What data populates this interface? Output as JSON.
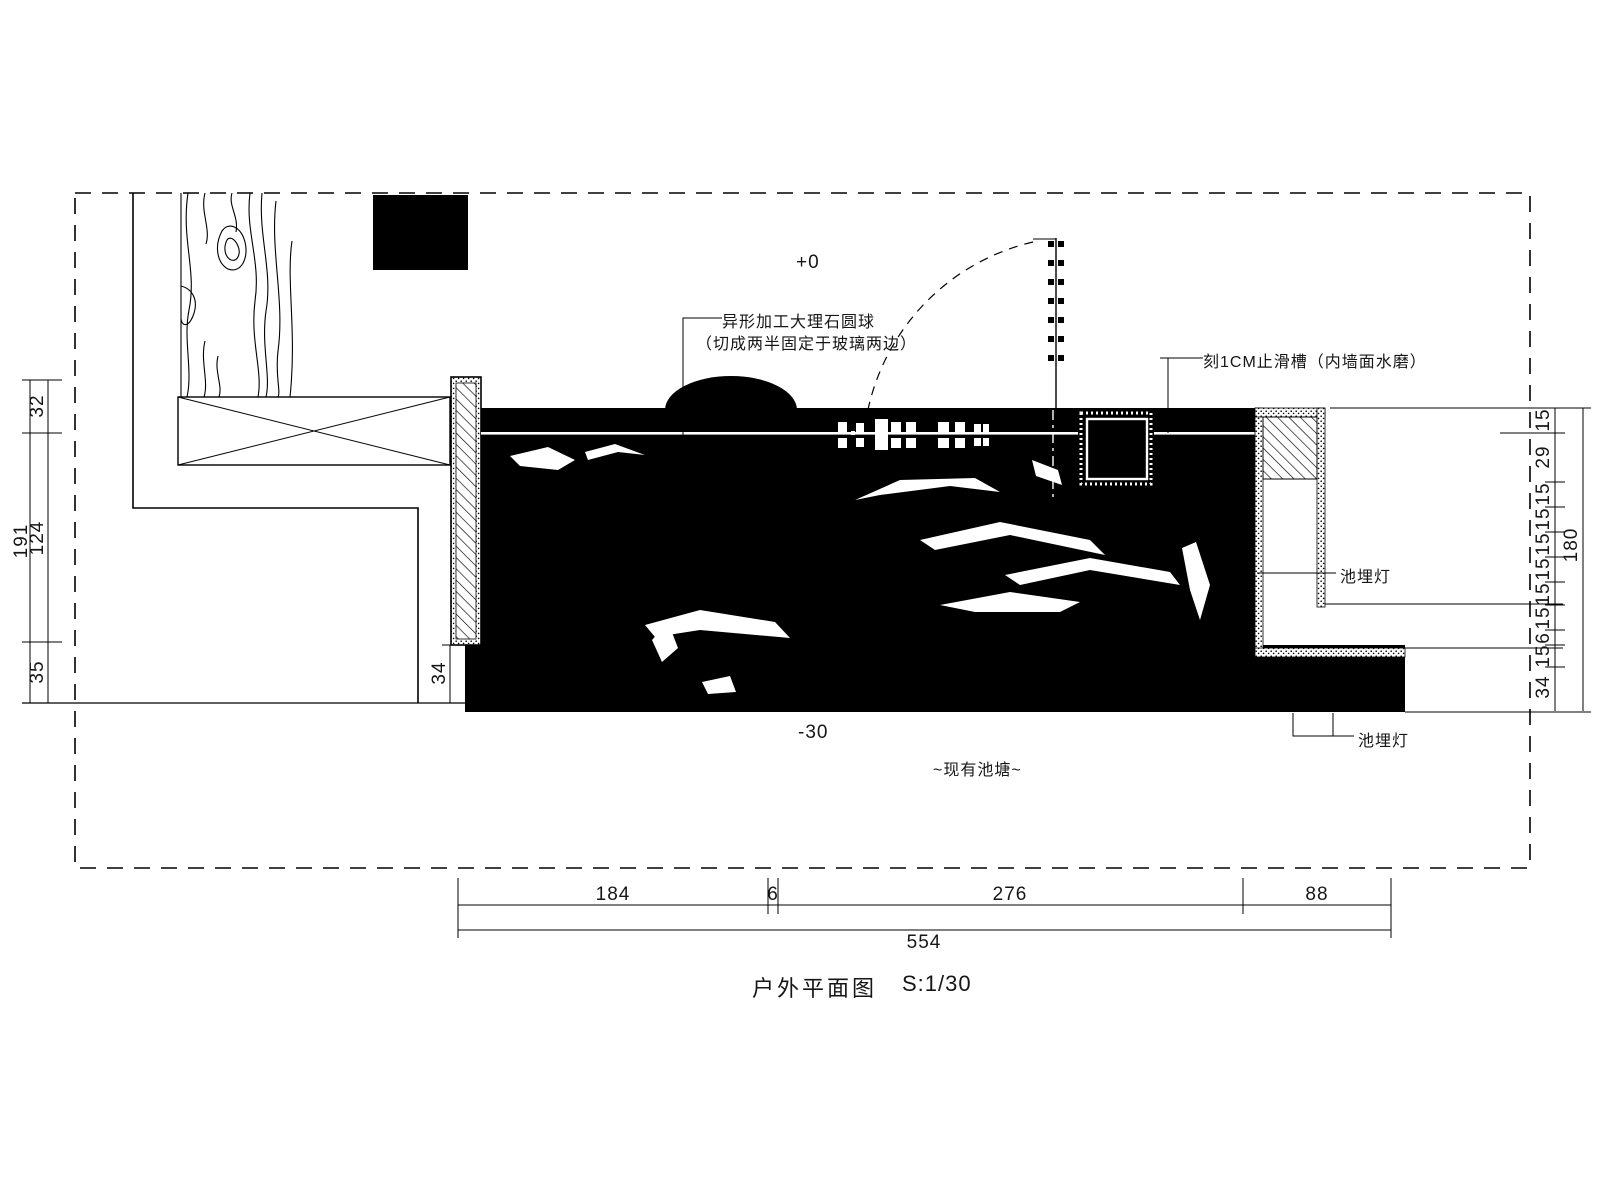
{
  "drawing": {
    "title": "户外平面图",
    "scale": "S:1/30",
    "levels": {
      "deck": "+0",
      "pond_bottom": "-30"
    },
    "pond_label": "~现有池塘~",
    "annotations": {
      "marble_ball_line1": "异形加工大理石圆球",
      "marble_ball_line2": "（切成两半固定于玻璃两边）",
      "antislip_groove": "刻1CM止滑槽（内墙面水磨）",
      "pool_light_upper": "池埋灯",
      "pool_light_lower": "池埋灯"
    },
    "dimensions": {
      "bottom": {
        "segments": [
          "184",
          "6",
          "276",
          "88"
        ],
        "total": "554"
      },
      "left": {
        "segments": [
          "32",
          "124",
          "35"
        ],
        "total": "191"
      },
      "right": {
        "segments": [
          "15",
          "29",
          "15",
          "15",
          "15",
          "15",
          "15",
          "15",
          "6",
          "15",
          "34"
        ],
        "total": "180"
      },
      "pool_edge_offset": "34"
    },
    "colors": {
      "line": "#000000",
      "pool_fill": "#000000",
      "background": "#ffffff"
    }
  }
}
